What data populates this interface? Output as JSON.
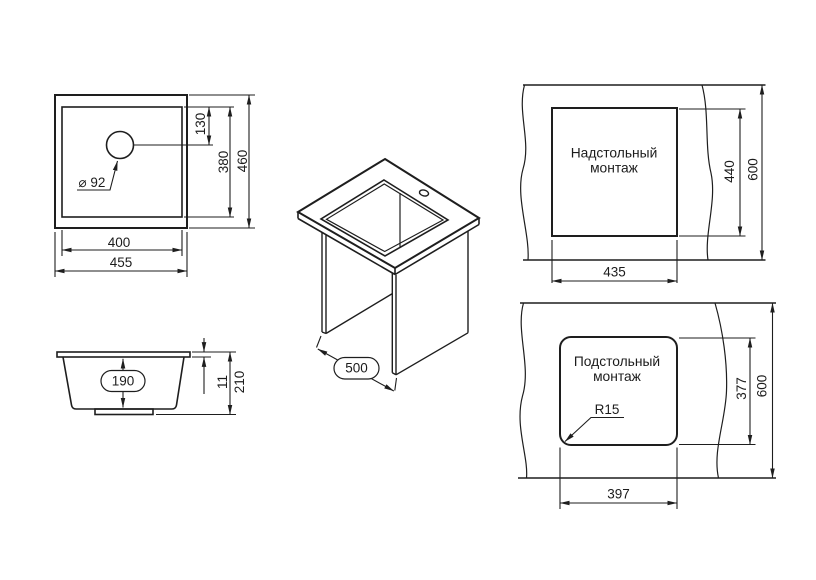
{
  "drawing": {
    "plan": {
      "hole_dia": "⌀ 92",
      "hole_offset": "130",
      "bowl_height": "380",
      "outer_height": "460",
      "bowl_width": "400",
      "outer_width": "455"
    },
    "section": {
      "bowl_depth": "190",
      "rim_thickness": "11",
      "total_height": "210"
    },
    "iso": {
      "cabinet_width": "500"
    },
    "overmount": {
      "label_line1": "Надстольный",
      "label_line2": "монтаж",
      "cutout_width": "435",
      "cutout_depth": "440",
      "counter_depth": "600"
    },
    "undermount": {
      "label_line1": "Подстольный",
      "label_line2": "монтаж",
      "cutout_width": "397",
      "cutout_depth": "377",
      "counter_depth": "600",
      "corner_radius": "R15"
    }
  }
}
